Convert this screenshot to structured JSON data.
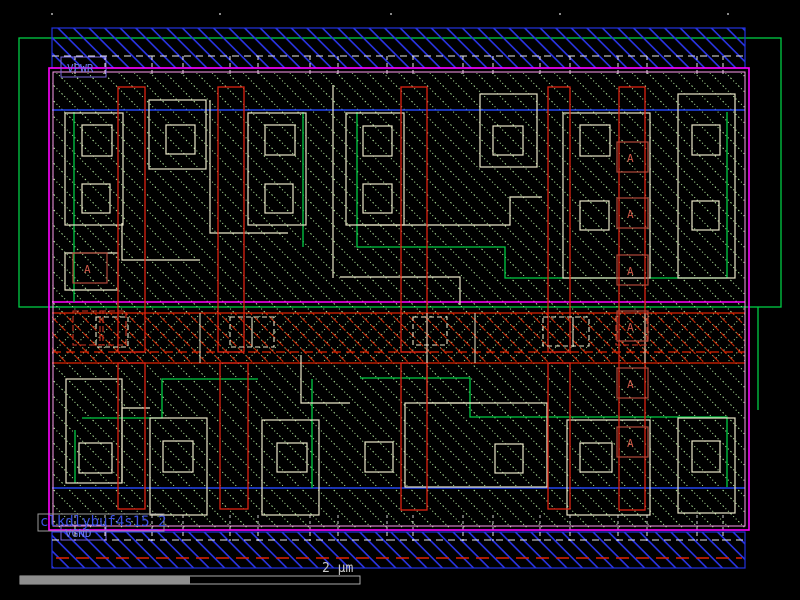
{
  "viewer": {
    "description": "IC standard-cell layout viewer canvas"
  },
  "labels": {
    "power_rail": "VPWR",
    "ground_rail": "VGND",
    "cell_name": "clkdlybuf4s15_2",
    "pin_a": "A"
  },
  "scale_bar": {
    "label": "2 μm"
  },
  "colors": {
    "background": "#000000",
    "rail_blue": "#2a35e0",
    "boundary_magenta": "#ff00ff",
    "boundary_pink": "#ff9bef",
    "well_green": "#00cc44",
    "poly_red": "#dd2211",
    "pin_marker_red": "#b04838",
    "diffusion_outline": "#eae6c8",
    "hatch_green": "#b8eea2",
    "implant_blue": "#2244ee",
    "label_purple": "#7766dd",
    "cell_name_blue": "#3b50e0",
    "scalebar_gray": "#999999",
    "rail_contact_white": "#e8e8e8"
  }
}
